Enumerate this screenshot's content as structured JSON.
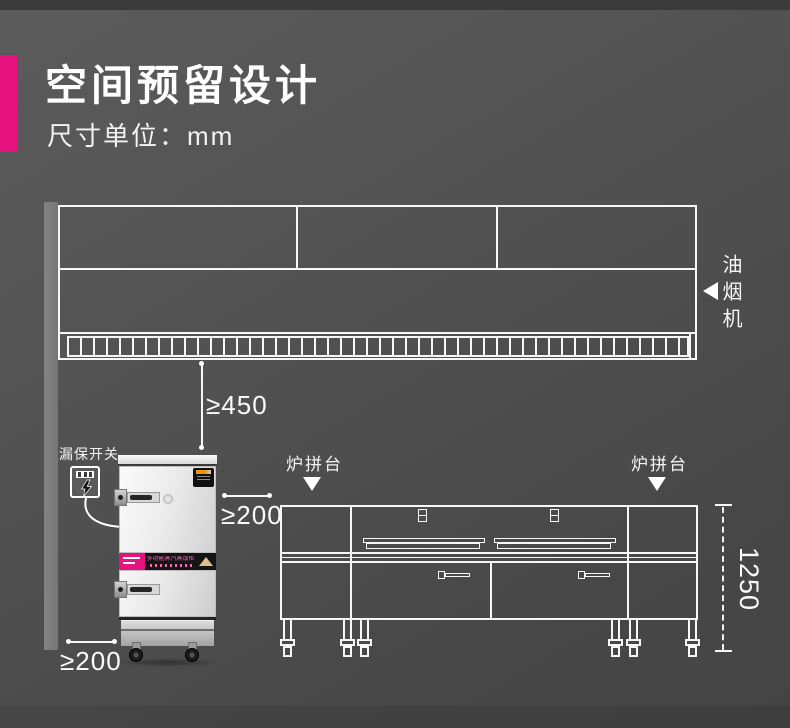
{
  "header": {
    "title": "空间预留设计",
    "subtitle": "尺寸单位：mm"
  },
  "colors": {
    "accent": "#e6127e",
    "background": "#4f4f4f",
    "line": "#f7f7f7"
  },
  "hood": {
    "label": "油烟机"
  },
  "leakage_switch": {
    "label": "漏保开关",
    "icon": "lightning-icon"
  },
  "steamer": {
    "band_text": "多功能蒸汽蒸饭柜"
  },
  "counter": {
    "left_label": "炉拼台",
    "right_label": "炉拼台"
  },
  "dimensions": {
    "hood_to_appliance": "≥450",
    "steamer_to_counter": "≥200",
    "steamer_to_wall": "≥200",
    "counter_height": "1250"
  }
}
